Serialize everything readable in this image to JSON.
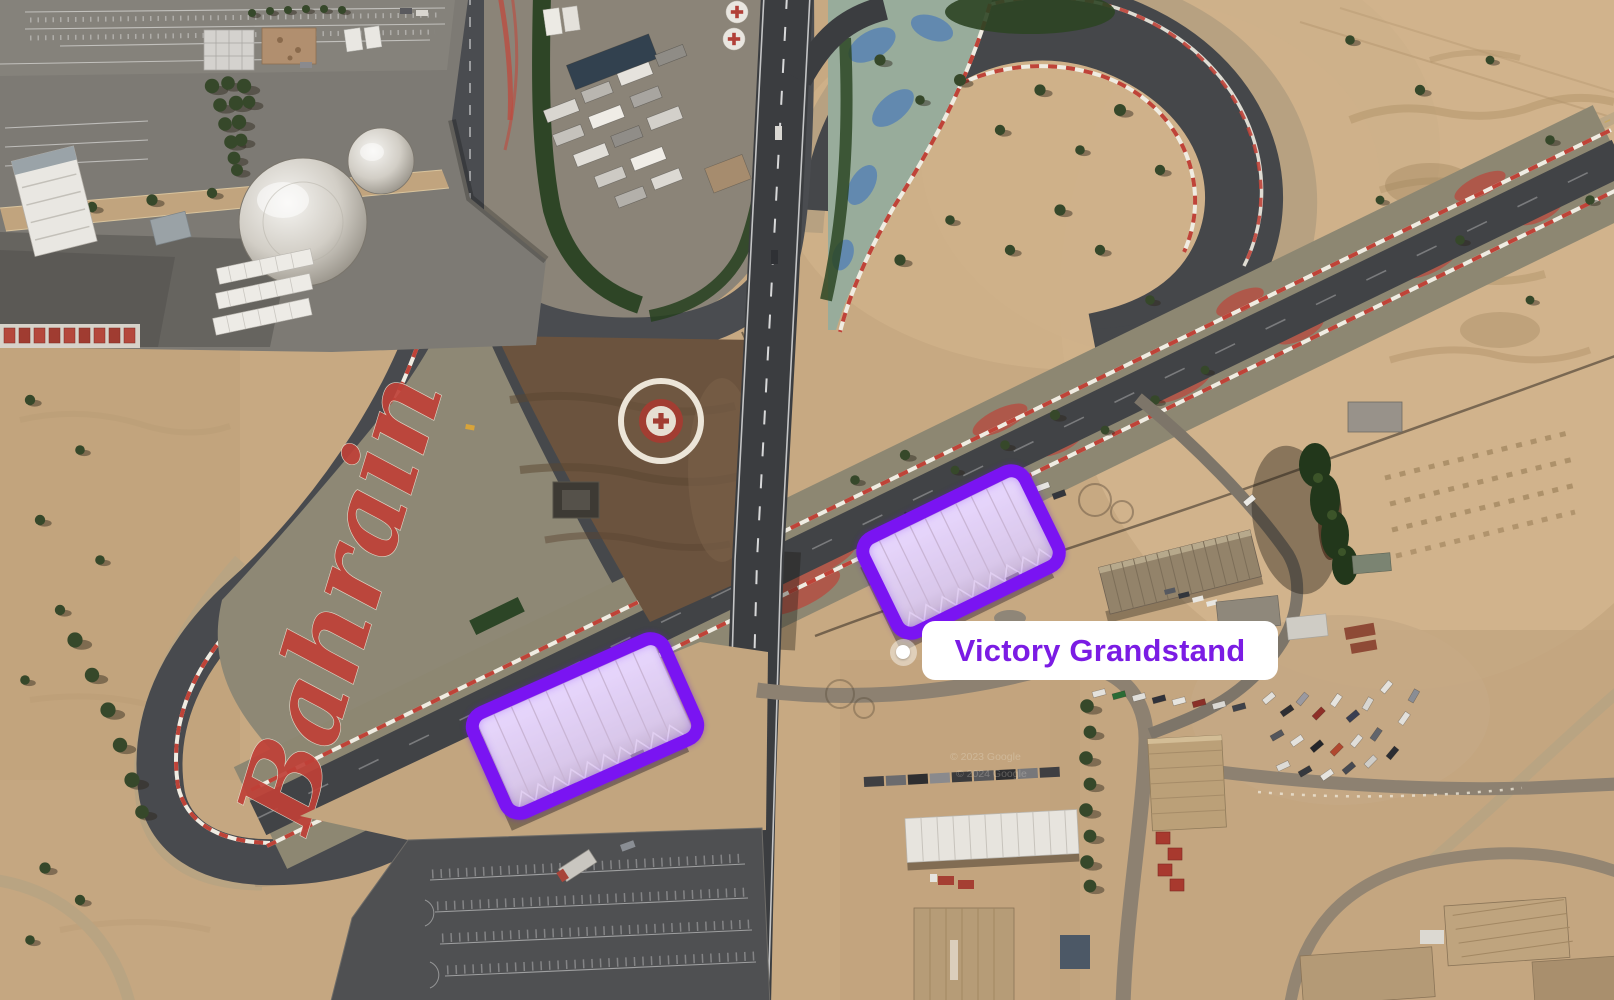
{
  "map": {
    "ground_text": "Bahrain",
    "watermark_2023": "© 2023 Google",
    "watermark_2024": "© 2024 Google"
  },
  "place": {
    "label": "Victory Grandstand",
    "colors": {
      "highlight": "#7a14f2",
      "label_text": "#7b1ce4",
      "label_bg": "#ffffff"
    },
    "marker": {
      "x": 903,
      "y": 652
    },
    "label_box": {
      "x": 922,
      "y": 621,
      "w": 356,
      "h": 59,
      "font_size": 31
    },
    "highlights": [
      {
        "id": "highlight-grandstand-north",
        "cx": 961,
        "cy": 552,
        "w": 192,
        "h": 118,
        "rot": -26
      },
      {
        "id": "highlight-grandstand-south",
        "cx": 585,
        "cy": 726,
        "w": 222,
        "h": 122,
        "rot": -24
      }
    ]
  }
}
